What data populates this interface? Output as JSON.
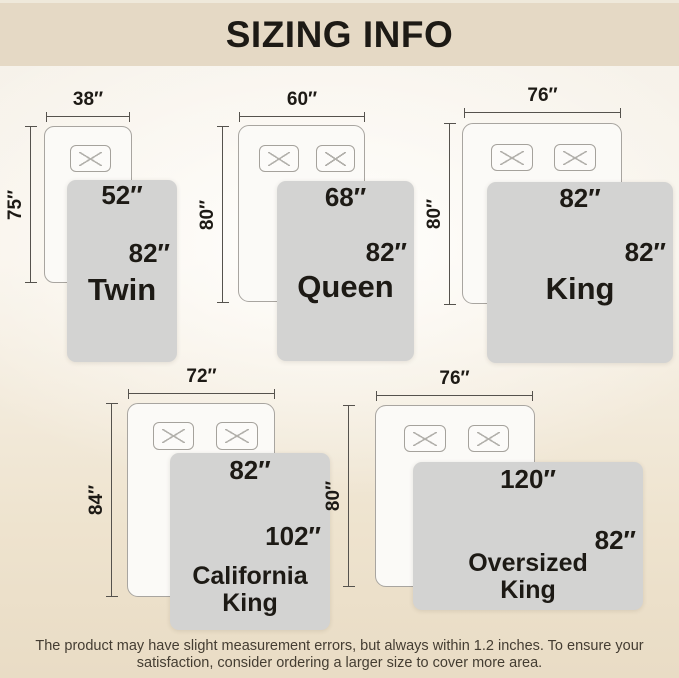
{
  "header": {
    "title": "SIZING INFO"
  },
  "diagrams": [
    {
      "name": "Twin",
      "name_lines": [
        "Twin"
      ],
      "bed_width": "38″",
      "bed_length": "75″",
      "blanket_width": "52″",
      "blanket_length": "82″",
      "pillow_count": 1
    },
    {
      "name": "Queen",
      "name_lines": [
        "Queen"
      ],
      "bed_width": "60″",
      "bed_length": "80″",
      "blanket_width": "68″",
      "blanket_length": "82″",
      "pillow_count": 2
    },
    {
      "name": "King",
      "name_lines": [
        "King"
      ],
      "bed_width": "76″",
      "bed_length": "80″",
      "blanket_width": "82″",
      "blanket_length": "82″",
      "pillow_count": 2
    },
    {
      "name": "California King",
      "name_lines": [
        "California",
        "King"
      ],
      "bed_width": "72″",
      "bed_length": "84″",
      "blanket_width": "82″",
      "blanket_length": "102″",
      "pillow_count": 2
    },
    {
      "name": "Oversized King",
      "name_lines": [
        "Oversized",
        "King"
      ],
      "bed_width": "76″",
      "bed_length": "80″",
      "blanket_width": "120″",
      "blanket_length": "82″",
      "pillow_count": 2
    }
  ],
  "footer": {
    "line1": "The product may have slight measurement errors, but always within 1.2 inches. To ensure your",
    "line2": "satisfaction, consider ordering a larger size to cover more area."
  },
  "colors": {
    "header_bg": "#e5d9c5",
    "page_bg_bottom": "#e9dcc5",
    "blanket_gray": "#d3d3d2",
    "bed_fill": "#fbfaf7",
    "outline_gray": "#a8a5a0",
    "text_dark": "#1d1a15"
  }
}
